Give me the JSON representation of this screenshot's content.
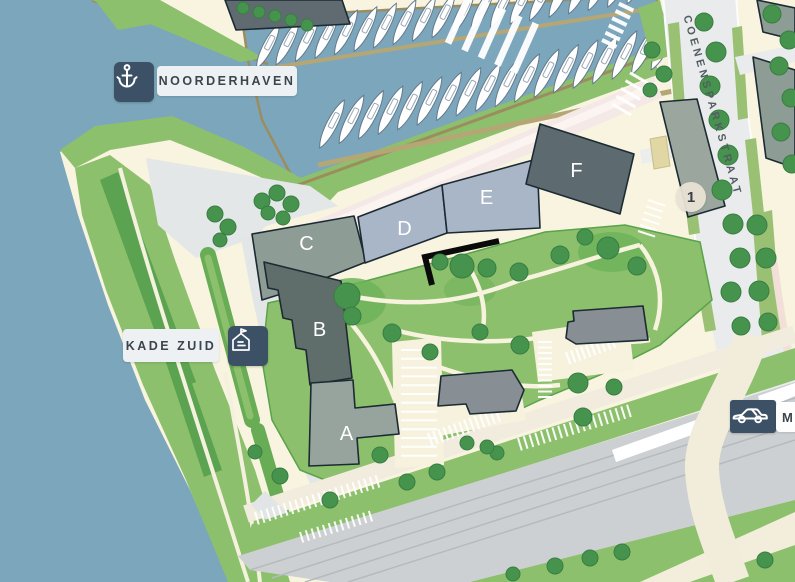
{
  "badges": {
    "noorderhaven": {
      "label": "NOORDERHAVEN",
      "icon": "anchor-pin"
    },
    "kade_zuid": {
      "label": "KADE ZUID",
      "icon": "apartment-building"
    },
    "motorway": {
      "label": "M",
      "icon": "car"
    }
  },
  "street_label": "COENENSPARKSTRAAT",
  "marker_1": "1",
  "buildings": [
    {
      "label": "A"
    },
    {
      "label": "B"
    },
    {
      "label": "C"
    },
    {
      "label": "D"
    },
    {
      "label": "E"
    },
    {
      "label": "F"
    }
  ],
  "colors": {
    "navy": "#3d5166",
    "water": "#7ca6bb",
    "land": "#f8f4df",
    "green": "#8cc06c",
    "green-dark": "#5ba350",
    "tree": "#46934e",
    "tree-edge": "#3a7d43",
    "plaza": "#e4e7e8",
    "road-pink": "#f4e9e6",
    "rail": "#cdd0d2",
    "badge-bg": "#eef1f4",
    "badge-text": "#3a454d",
    "bldg-a": "#97a49e",
    "bldg-b": "#5f6e6a",
    "bldg-c": "#8e9c96",
    "bldg-d": "#a9b6c8",
    "bldg-e": "#a9b6c8",
    "bldg-f": "#5d6b70",
    "bldg-gray": "#878f94",
    "outline": "#1c2a33"
  }
}
